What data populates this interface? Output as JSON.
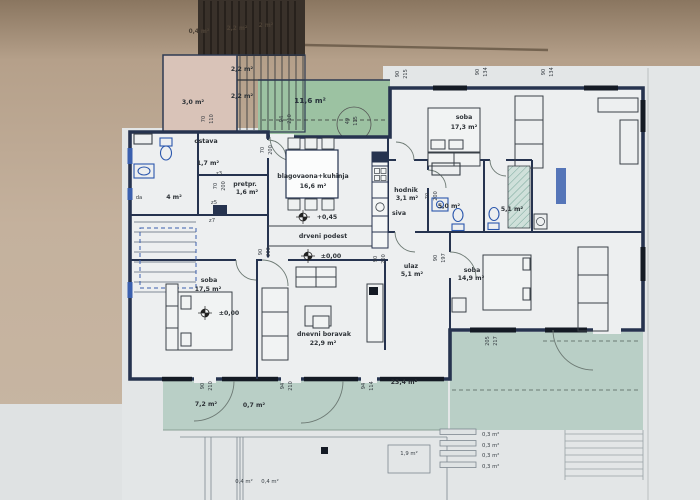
{
  "palette": {
    "photo_bg": "#bda88f",
    "photo_bg_dark": "#7f6c57",
    "sheet": "#e3e6e7",
    "room": "#edeff0",
    "green_top": "#9cc2a2",
    "green_terrace": "#b9cfc6",
    "pink": "#d9c3b8",
    "wall": "#26334f",
    "fixture_blue": "#3a5fae",
    "ink": "#3a4148",
    "stair_dark": "#39312a"
  },
  "rooms": {
    "storage": {
      "area": "3,0 m²"
    },
    "stair_upper": {
      "area": "2,2 m²"
    },
    "stair_lower_cell": {
      "area": "2,2 m²"
    },
    "terrace_top": {
      "area": "11,6 m²"
    },
    "soba_ne": {
      "name": "soba",
      "area": "17,3 m²"
    },
    "ostava": {
      "name": "ostava",
      "area": "1,7 m²"
    },
    "pretprostor": {
      "name": "pretpr.",
      "area": "1,6 m²"
    },
    "blagovaona": {
      "name": "blagovaona+kuhinja",
      "area": "16,6 m²"
    },
    "hodnik": {
      "name": "hodnik",
      "area": "3,1 m²",
      "note": "siva"
    },
    "bath_a": {
      "area": "5,0 m²"
    },
    "bath_b": {
      "area": "5,1 m²"
    },
    "bath_left": {
      "area": "4 m²",
      "partial": "da"
    },
    "ulaz": {
      "name": "ulaz",
      "area": "5,1 m²"
    },
    "soba_w": {
      "name": "soba",
      "area": "17,5 m²"
    },
    "dnevni": {
      "name": "dnevni boravak",
      "area": "22,9 m²"
    },
    "soba_se": {
      "name": "soba",
      "area": "14,9 m²"
    },
    "terrace_w": {
      "area": "7,2 m²"
    },
    "terrace_c": {
      "area": "0,7 m²"
    },
    "terrace_e": {
      "area": "23,4 m²"
    },
    "stair_ext": {
      "area": "1,9 m²"
    },
    "step1": "0,3 m²",
    "step2": "0,3 m²",
    "step3": "0,3 m²",
    "step4": "0,3 m²",
    "col1": "0,4 m²",
    "col2": "0,4 m²",
    "attic1": "0,4 m²",
    "attic2": "2,2 m²",
    "attic3": "2 m²"
  },
  "annotations": {
    "podest": "drveni podest",
    "elev_kitchen": "+0,45",
    "elev_podest": "±0,00",
    "elev_soba": "±0,00",
    "z3": "z3",
    "z5": "z5",
    "z7": "z7"
  },
  "dims": {
    "d1a": "90",
    "d1b": "215",
    "d2a": "90",
    "d2b": "134",
    "d3a": "90",
    "d3b": "134",
    "d4a": "70",
    "d4b": "110",
    "d5a": "94",
    "d5b": "210",
    "d6a": "49",
    "d6b": "115",
    "d7a": "70",
    "d7b": "200",
    "d8a": "70",
    "d8b": "200",
    "d9a": "70",
    "d9b": "200",
    "d10a": "90",
    "d10b": "200",
    "d11a": "90",
    "d11b": "200",
    "d12a": "90",
    "d12b": "197",
    "d13a": "90",
    "d13b": "210",
    "d14a": "94",
    "d14b": "210",
    "d15a": "94",
    "d15b": "114",
    "d16a": "205",
    "d16b": "217"
  }
}
